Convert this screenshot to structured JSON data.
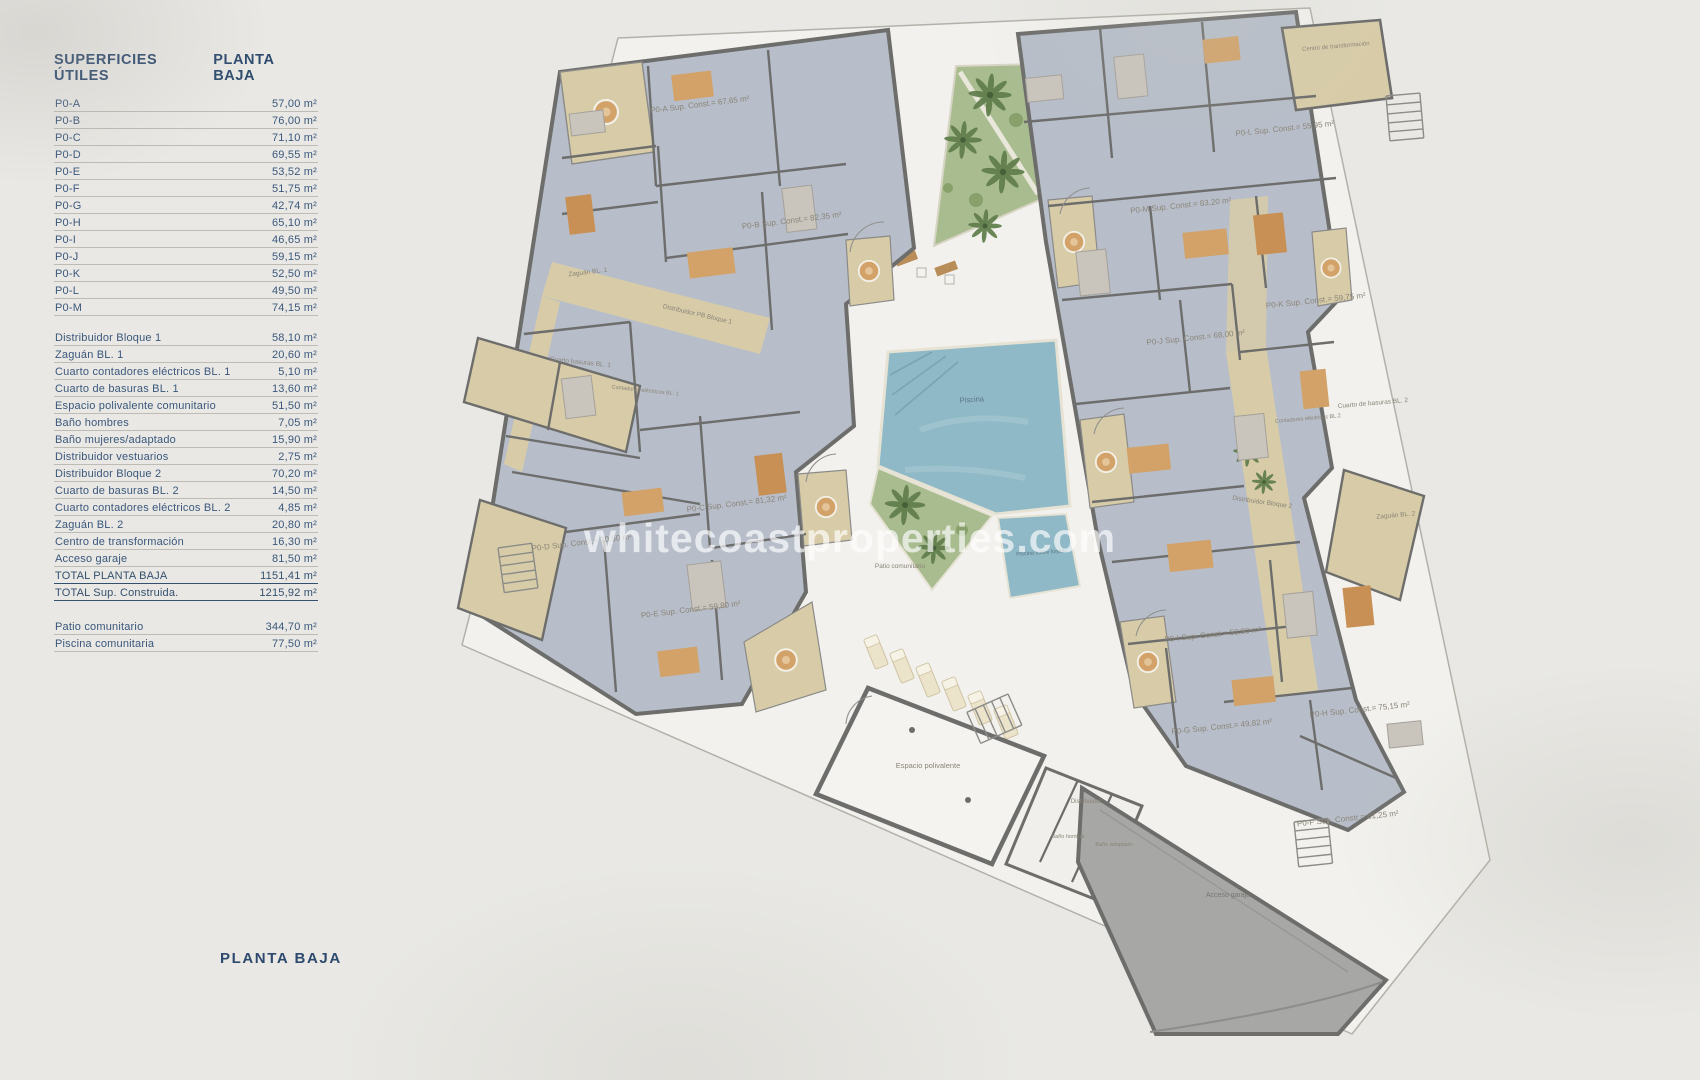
{
  "colors": {
    "background": "#e9e8e4",
    "plot_fill": "#f2f1ed",
    "navy_text": "#2d4a6e",
    "room_fill": "#b7bec9",
    "corridor_tan": "#d8cca8",
    "wall_gray": "#6d6d6c",
    "pool_blue": "#8fb9c6",
    "garden_green": "#a9bc90",
    "garage_gray": "#a6a6a4",
    "furniture_orange": "#d2a269"
  },
  "sidebar": {
    "header": {
      "left": "SUPERFICIES ÚTILES",
      "right": "PLANTA BAJA"
    },
    "unit_rows": [
      {
        "label": "P0-A",
        "value": "57,00 m²"
      },
      {
        "label": "P0-B",
        "value": "76,00 m²"
      },
      {
        "label": "P0-C",
        "value": "71,10 m²"
      },
      {
        "label": "P0-D",
        "value": "69,55 m²"
      },
      {
        "label": "P0-E",
        "value": "53,52 m²"
      },
      {
        "label": "P0-F",
        "value": "51,75 m²"
      },
      {
        "label": "P0-G",
        "value": "42,74 m²"
      },
      {
        "label": "P0-H",
        "value": "65,10 m²"
      },
      {
        "label": "P0-I",
        "value": "46,65 m²"
      },
      {
        "label": "P0-J",
        "value": "59,15 m²"
      },
      {
        "label": "P0-K",
        "value": "52,50 m²"
      },
      {
        "label": "P0-L",
        "value": "49,50 m²"
      },
      {
        "label": "P0-M",
        "value": "74,15 m²"
      }
    ],
    "common_rows": [
      {
        "label": "Distribuidor Bloque 1",
        "value": "58,10 m²"
      },
      {
        "label": "Zaguán BL. 1",
        "value": "20,60 m²"
      },
      {
        "label": "Cuarto contadores eléctricos BL. 1",
        "value": "5,10 m²"
      },
      {
        "label": "Cuarto de basuras BL. 1",
        "value": "13,60 m²"
      },
      {
        "label": "Espacio polivalente comunitario",
        "value": "51,50 m²"
      },
      {
        "label": "Baño hombres",
        "value": "7,05 m²"
      },
      {
        "label": "Baño mujeres/adaptado",
        "value": "15,90 m²"
      },
      {
        "label": "Distribuidor vestuarios",
        "value": "2,75 m²"
      },
      {
        "label": "Distribuidor Bloque 2",
        "value": "70,20 m²"
      },
      {
        "label": "Cuarto de basuras BL. 2",
        "value": "14,50 m²"
      },
      {
        "label": "Cuarto contadores eléctricos BL. 2",
        "value": "4,85 m²"
      },
      {
        "label": "Zaguán BL. 2",
        "value": "20,80 m²"
      },
      {
        "label": "Centro de transformación",
        "value": "16,30 m²"
      },
      {
        "label": "Acceso garaje",
        "value": "81,50 m²"
      },
      {
        "label": "TOTAL PLANTA BAJA",
        "value": "1151,41 m²"
      },
      {
        "label": "TOTAL Sup. Construida.",
        "value": "1215,92 m²"
      }
    ],
    "extra_rows": [
      {
        "label": "Patio comunitario",
        "value": "344,70 m²"
      },
      {
        "label": "Piscina comunitaria",
        "value": "77,50 m²"
      }
    ],
    "footer": "PLANTA BAJA"
  },
  "plan": {
    "watermark": "whitecoastproperties.com",
    "labels": [
      {
        "text": "P0-A Sup. Const.= 67,65 m²"
      },
      {
        "text": "P0-B Sup. Const.= 82,35 m²"
      },
      {
        "text": "P0-C Sup. Const.= 81,32 m²"
      },
      {
        "text": "P0-D Sup. Const.= 70,50 m²"
      },
      {
        "text": "P0-E Sup. Const.= 59,80 m²"
      },
      {
        "text": "P0-F Sup. Constr.= 61,25 m²"
      },
      {
        "text": "P0-G Sup. Const.= 49,82 m²"
      },
      {
        "text": "P0-H Sup. Const.= 75,15 m²"
      },
      {
        "text": "P0-I Sup. Const.= 53,90 m²"
      },
      {
        "text": "P0-J Sup. Const.= 68,00 m²"
      },
      {
        "text": "P0-K Sup. Const.= 59,75 m²"
      },
      {
        "text": "P0-L Sup. Const.= 55,95 m²"
      },
      {
        "text": "P0-M Sup. Const.= 83,20 m²"
      },
      {
        "text": "Zaguán BL. 1"
      },
      {
        "text": "Distribuidor PB Bloque 1"
      },
      {
        "text": "Cuarto basuras BL. 1"
      },
      {
        "text": "Contadores eléctricos BL. 1"
      },
      {
        "text": "Cuarto de basuras BL. 2"
      },
      {
        "text": "Contadores eléctricos BL.2"
      },
      {
        "text": "Distribuidor Bloque 2"
      },
      {
        "text": "Zaguán BL. 2"
      },
      {
        "text": "Centro de transformación"
      },
      {
        "text": "Espacio polivalente"
      },
      {
        "text": "Distribuidor"
      },
      {
        "text": "Baño hombre"
      },
      {
        "text": "Baño adaptado"
      },
      {
        "text": "Acceso garaje"
      },
      {
        "text": "Piscina"
      },
      {
        "text": "Piscina sobre forjado"
      },
      {
        "text": "Patio comunitario"
      }
    ]
  }
}
